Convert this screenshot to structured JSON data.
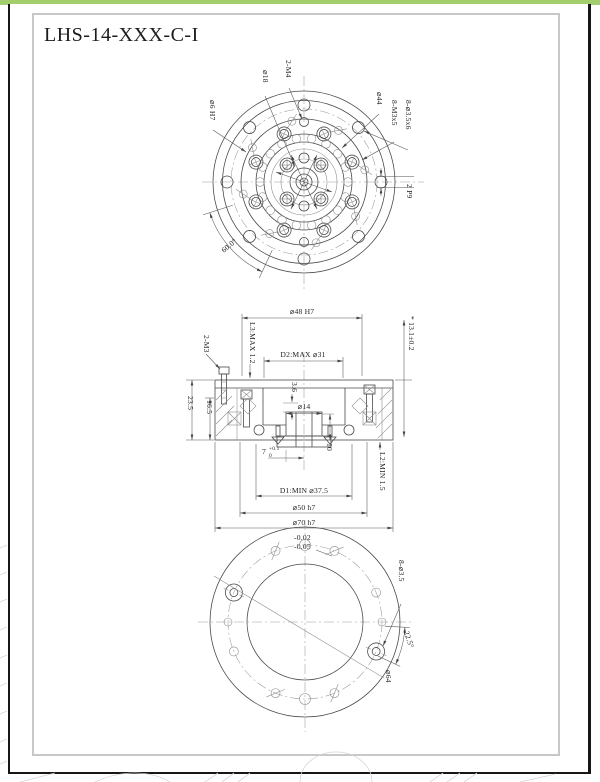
{
  "title": "LHS-14-XXX-C-I",
  "colors": {
    "accent_bar": "#a4ce6e",
    "drawing_line": "#4a4a4a"
  },
  "top_view": {
    "labels": {
      "tapped_m4": "2-M4",
      "dia_18": "⌀18",
      "dia_44": "⌀44",
      "screws_m3": "8-M3x5",
      "holes_35x6": "8-⌀3.5x6",
      "key_2p9": "2 P9",
      "dowel_6h7": "⌀6 H7",
      "angle_60": "60.0°"
    }
  },
  "section_view": {
    "labels": {
      "dia_48": "⌀48 H7",
      "height_131": "* 13.1±0.2",
      "l3": "L3:MAX 1.2",
      "d2": "D2:MAX ⌀31",
      "screws_m3": "2-M3",
      "h_235": "23.5",
      "h_165": "16.5",
      "h_36": "3.6",
      "dia_14": "⌀14",
      "depth_7": "7",
      "depth_7_tol_upper": "+0.1",
      "depth_7_tol_lower": "0",
      "h_10": "10",
      "l2": "L2:MIN 1.5",
      "d1": "D1:MIN ⌀37.5",
      "dia_50": "⌀50 h7",
      "dia_70": "⌀70 h7"
    }
  },
  "bottom_view": {
    "labels": {
      "tol_upper": "-0.02",
      "tol_lower": "-0.05",
      "holes_35": "8-⌀3.5",
      "angle_225": "22.5°",
      "dia_64": "⌀64"
    }
  }
}
